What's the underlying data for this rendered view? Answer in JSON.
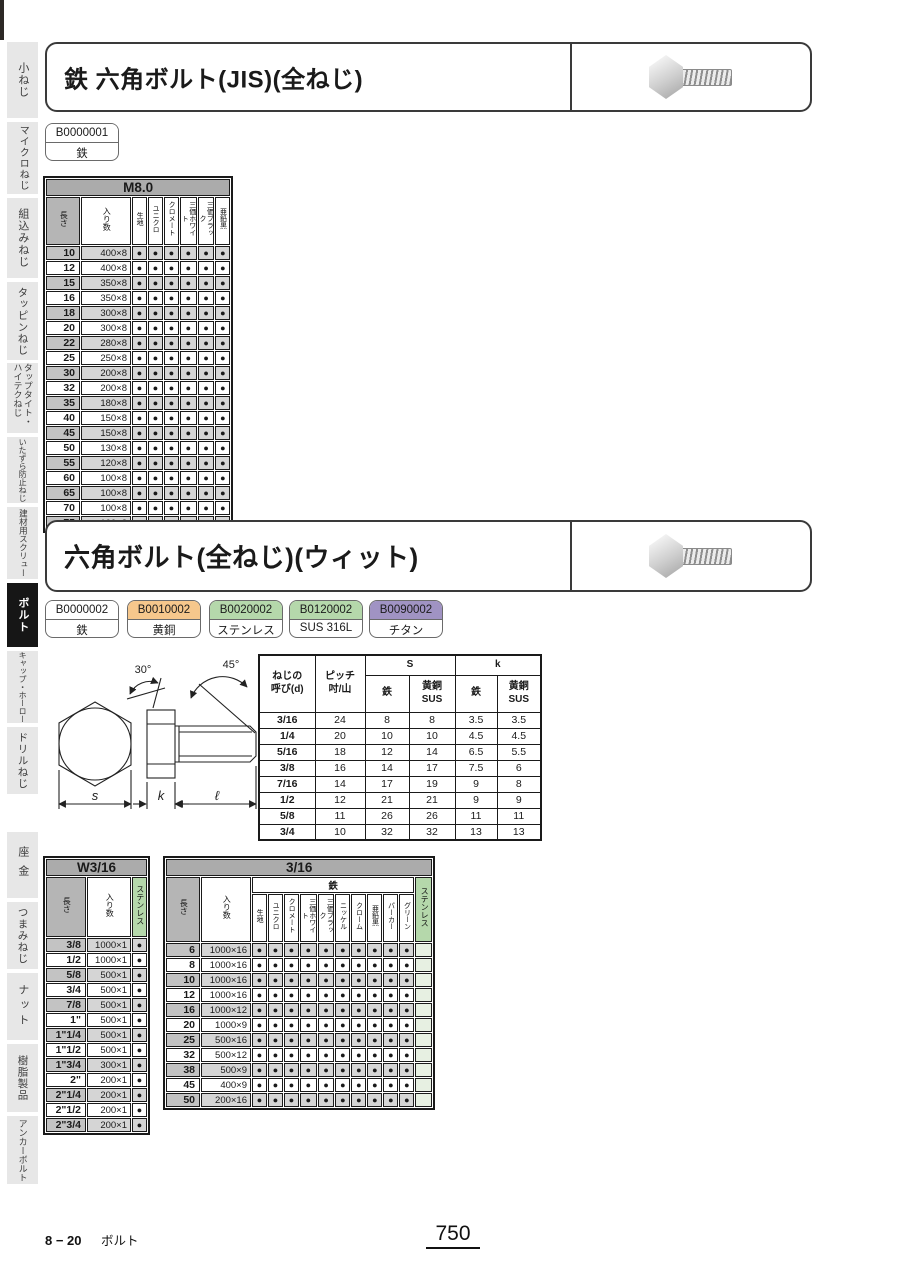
{
  "dot_char": "●",
  "labels": {
    "length": "長さ",
    "qty": "入り数",
    "iron": "鉄",
    "sus": "ステンレス"
  },
  "sidebar": {
    "items": [
      {
        "label": "小ねじ",
        "active": false
      },
      {
        "label": "マイクロねじ",
        "active": false
      },
      {
        "label": "組込みねじ",
        "active": false
      },
      {
        "label": "タッピンねじ",
        "active": false
      },
      {
        "label": "タップタイト・ハイテクねじ",
        "active": false
      },
      {
        "label": "いたずら防止ねじ",
        "active": false
      },
      {
        "label": "建材用スクリュー",
        "active": false
      },
      {
        "label": "ボルト",
        "active": true
      },
      {
        "label": "キャップ・ホーロー",
        "active": false
      },
      {
        "label": "ドリルねじ",
        "active": false
      },
      {
        "label": "座金",
        "active": false
      },
      {
        "label": "つまみねじ",
        "active": false
      },
      {
        "label": "ナット",
        "active": false
      },
      {
        "label": "樹脂製品",
        "active": false
      },
      {
        "label": "アンカーボルト",
        "active": false
      }
    ]
  },
  "section1": {
    "title": "鉄 六角ボルト(JIS)(全ねじ)",
    "tags": [
      {
        "code": "B0000001",
        "material": "鉄",
        "color": "#ffffff"
      }
    ],
    "table": {
      "title": "M8.0",
      "finish_columns": [
        "生地",
        "ユニクロ",
        "クロメート",
        "三価ホワイト",
        "三価ブラック",
        "亜鉛黒"
      ],
      "rows": [
        {
          "length": "10",
          "qty": "400×8",
          "dots": [
            1,
            1,
            1,
            1,
            1,
            1
          ]
        },
        {
          "length": "12",
          "qty": "400×8",
          "dots": [
            1,
            1,
            1,
            1,
            1,
            1
          ]
        },
        {
          "length": "15",
          "qty": "350×8",
          "dots": [
            1,
            1,
            1,
            1,
            1,
            1
          ]
        },
        {
          "length": "16",
          "qty": "350×8",
          "dots": [
            1,
            1,
            1,
            1,
            1,
            1
          ]
        },
        {
          "length": "18",
          "qty": "300×8",
          "dots": [
            1,
            1,
            1,
            1,
            1,
            1
          ]
        },
        {
          "length": "20",
          "qty": "300×8",
          "dots": [
            1,
            1,
            1,
            1,
            1,
            1
          ]
        },
        {
          "length": "22",
          "qty": "280×8",
          "dots": [
            1,
            1,
            1,
            1,
            1,
            1
          ]
        },
        {
          "length": "25",
          "qty": "250×8",
          "dots": [
            1,
            1,
            1,
            1,
            1,
            1
          ]
        },
        {
          "length": "30",
          "qty": "200×8",
          "dots": [
            1,
            1,
            1,
            1,
            1,
            1
          ]
        },
        {
          "length": "32",
          "qty": "200×8",
          "dots": [
            1,
            1,
            1,
            1,
            1,
            1
          ]
        },
        {
          "length": "35",
          "qty": "180×8",
          "dots": [
            1,
            1,
            1,
            1,
            1,
            1
          ]
        },
        {
          "length": "40",
          "qty": "150×8",
          "dots": [
            1,
            1,
            1,
            1,
            1,
            1
          ]
        },
        {
          "length": "45",
          "qty": "150×8",
          "dots": [
            1,
            1,
            1,
            1,
            1,
            1
          ]
        },
        {
          "length": "50",
          "qty": "130×8",
          "dots": [
            1,
            1,
            1,
            1,
            1,
            1
          ]
        },
        {
          "length": "55",
          "qty": "120×8",
          "dots": [
            1,
            1,
            1,
            1,
            1,
            1
          ]
        },
        {
          "length": "60",
          "qty": "100×8",
          "dots": [
            1,
            1,
            1,
            1,
            1,
            1
          ]
        },
        {
          "length": "65",
          "qty": "100×8",
          "dots": [
            1,
            1,
            1,
            1,
            1,
            1
          ]
        },
        {
          "length": "70",
          "qty": "100×8",
          "dots": [
            1,
            1,
            1,
            1,
            1,
            1
          ]
        },
        {
          "length": "75",
          "qty": "100×8",
          "dots": [
            1,
            1,
            1,
            1,
            1,
            1
          ]
        }
      ]
    }
  },
  "section2": {
    "title": "六角ボルト(全ねじ)(ウィット)",
    "tags": [
      {
        "code": "B0000002",
        "material": "鉄",
        "color": "#ffffff"
      },
      {
        "code": "B0010002",
        "material": "黄銅",
        "color": "#f6c78c"
      },
      {
        "code": "B0020002",
        "material": "ステンレス",
        "color": "#b5d8ab"
      },
      {
        "code": "B0120002",
        "material": "SUS 316L",
        "color": "#b5d8ab"
      },
      {
        "code": "B0090002",
        "material": "チタン",
        "color": "#a093c3"
      }
    ],
    "diagram": {
      "angle_head": "30°",
      "angle_tip": "45°",
      "dim_s": "s",
      "dim_k": "k",
      "dim_l": "ℓ"
    },
    "spec_table": {
      "headers": {
        "size": "ねじの\n呼び(d)",
        "pitch": "ピッチ\n吋/山",
        "s": "S",
        "k": "k",
        "iron": "鉄",
        "brass": "黄銅\nSUS"
      },
      "rows": [
        [
          "3/16",
          "24",
          "8",
          "8",
          "3.5",
          "3.5"
        ],
        [
          "1/4",
          "20",
          "10",
          "10",
          "4.5",
          "4.5"
        ],
        [
          "5/16",
          "18",
          "12",
          "14",
          "6.5",
          "5.5"
        ],
        [
          "3/8",
          "16",
          "14",
          "17",
          "7.5",
          "6"
        ],
        [
          "7/16",
          "14",
          "17",
          "19",
          "9",
          "8"
        ],
        [
          "1/2",
          "12",
          "21",
          "21",
          "9",
          "9"
        ],
        [
          "5/8",
          "11",
          "26",
          "26",
          "11",
          "11"
        ],
        [
          "3/4",
          "10",
          "32",
          "32",
          "13",
          "13"
        ]
      ]
    },
    "w316_table": {
      "title": "W3/16",
      "rows": [
        {
          "length": "3/8",
          "qty": "1000×1",
          "sus": true
        },
        {
          "length": "1/2",
          "qty": "1000×1",
          "sus": true
        },
        {
          "length": "5/8",
          "qty": "500×1",
          "sus": true
        },
        {
          "length": "3/4",
          "qty": "500×1",
          "sus": true
        },
        {
          "length": "7/8",
          "qty": "500×1",
          "sus": true
        },
        {
          "length": "1\"",
          "qty": "500×1",
          "sus": true
        },
        {
          "length": "1\"1/4",
          "qty": "500×1",
          "sus": true
        },
        {
          "length": "1\"1/2",
          "qty": "500×1",
          "sus": true
        },
        {
          "length": "1\"3/4",
          "qty": "300×1",
          "sus": true
        },
        {
          "length": "2\"",
          "qty": "200×1",
          "sus": true
        },
        {
          "length": "2\"1/4",
          "qty": "200×1",
          "sus": true
        },
        {
          "length": "2\"1/2",
          "qty": "200×1",
          "sus": true
        },
        {
          "length": "2\"3/4",
          "qty": "200×1",
          "sus": true
        }
      ]
    },
    "table316": {
      "title": "3/16",
      "iron_columns": [
        "生地",
        "ユニクロ",
        "クロメート",
        "三価ホワイト",
        "三価ブラック",
        "ニッケル",
        "クローム",
        "亜鉛黒",
        "パーカー",
        "グリーン"
      ],
      "rows": [
        {
          "length": "6",
          "qty": "1000×16",
          "dots": [
            1,
            1,
            1,
            1,
            1,
            1,
            1,
            1,
            1,
            1
          ],
          "sus": false
        },
        {
          "length": "8",
          "qty": "1000×16",
          "dots": [
            1,
            1,
            1,
            1,
            1,
            1,
            1,
            1,
            1,
            1
          ],
          "sus": false
        },
        {
          "length": "10",
          "qty": "1000×16",
          "dots": [
            1,
            1,
            1,
            1,
            1,
            1,
            1,
            1,
            1,
            1
          ],
          "sus": false
        },
        {
          "length": "12",
          "qty": "1000×16",
          "dots": [
            1,
            1,
            1,
            1,
            1,
            1,
            1,
            1,
            1,
            1
          ],
          "sus": false
        },
        {
          "length": "16",
          "qty": "1000×12",
          "dots": [
            1,
            1,
            1,
            1,
            1,
            1,
            1,
            1,
            1,
            1
          ],
          "sus": false
        },
        {
          "length": "20",
          "qty": "1000×9",
          "dots": [
            1,
            1,
            1,
            1,
            1,
            1,
            1,
            1,
            1,
            1
          ],
          "sus": false
        },
        {
          "length": "25",
          "qty": "500×16",
          "dots": [
            1,
            1,
            1,
            1,
            1,
            1,
            1,
            1,
            1,
            1
          ],
          "sus": false
        },
        {
          "length": "32",
          "qty": "500×12",
          "dots": [
            1,
            1,
            1,
            1,
            1,
            1,
            1,
            1,
            1,
            1
          ],
          "sus": false
        },
        {
          "length": "38",
          "qty": "500×9",
          "dots": [
            1,
            1,
            1,
            1,
            1,
            1,
            1,
            1,
            1,
            1
          ],
          "sus": false
        },
        {
          "length": "45",
          "qty": "400×9",
          "dots": [
            1,
            1,
            1,
            1,
            1,
            1,
            1,
            1,
            1,
            1
          ],
          "sus": false
        },
        {
          "length": "50",
          "qty": "200×16",
          "dots": [
            1,
            1,
            1,
            1,
            1,
            1,
            1,
            1,
            1,
            1
          ],
          "sus": false
        }
      ]
    }
  },
  "footer": {
    "left_code": "8 − 20",
    "left_label": "ボルト",
    "page_number": "750"
  }
}
